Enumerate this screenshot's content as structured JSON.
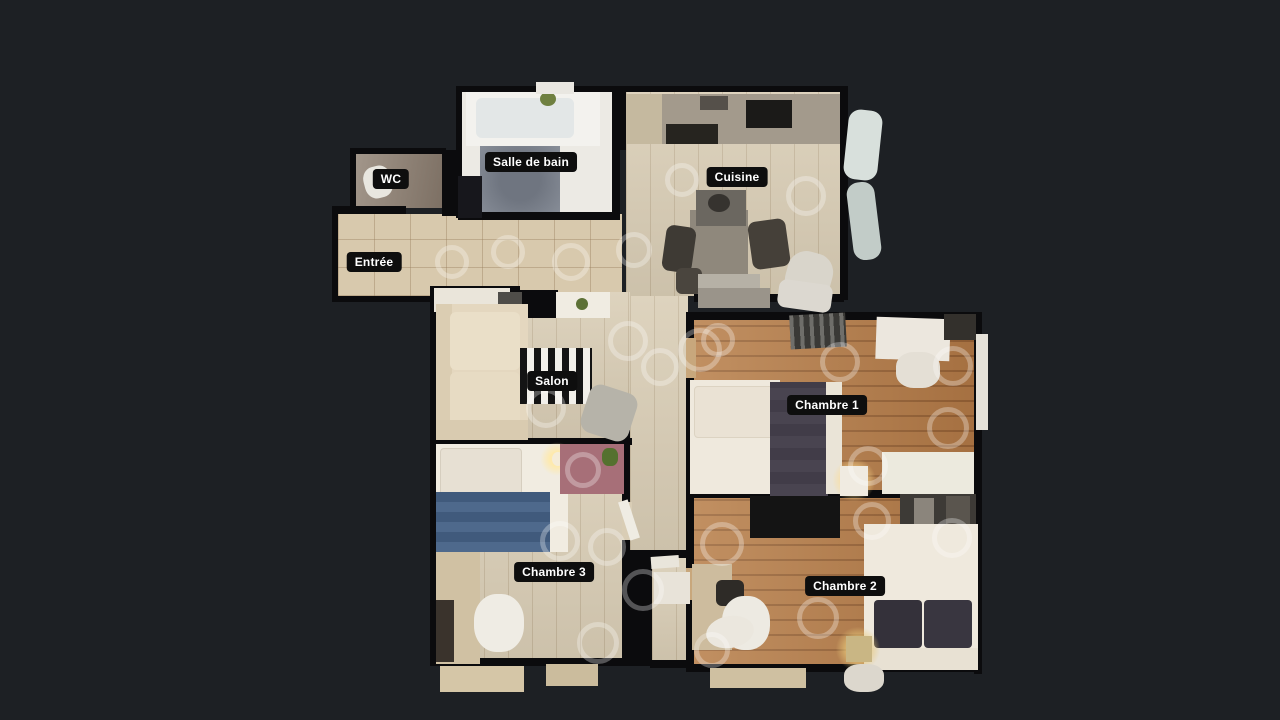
{
  "viewer": {
    "mode_label": "Floorplan view"
  },
  "rooms": [
    {
      "id": "wc",
      "label": "WC"
    },
    {
      "id": "salle-de-bain",
      "label": "Salle de bain"
    },
    {
      "id": "cuisine",
      "label": "Cuisine"
    },
    {
      "id": "entree",
      "label": "Entrée"
    },
    {
      "id": "salon",
      "label": "Salon"
    },
    {
      "id": "chambre-1",
      "label": "Chambre 1"
    },
    {
      "id": "chambre-3",
      "label": "Chambre 3"
    },
    {
      "id": "chambre-2",
      "label": "Chambre 2"
    }
  ],
  "colors": {
    "background": "#1d2024",
    "wall": "#0b0b0d",
    "label_bg": "#0e0e0e",
    "label_text": "#ffffff",
    "ring": "rgba(255,255,255,0.30)",
    "floor_light": "#d9cdb5",
    "floor_tile": "#d8c9ad",
    "floor_wood": "#b57d4a",
    "floor_bath": "#eceae4",
    "floor_wc": "#8b7f73"
  },
  "scan_points": [
    {
      "x": 452,
      "y": 262,
      "d": 34
    },
    {
      "x": 508,
      "y": 252,
      "d": 34
    },
    {
      "x": 571,
      "y": 262,
      "d": 38
    },
    {
      "x": 634,
      "y": 250,
      "d": 36
    },
    {
      "x": 682,
      "y": 180,
      "d": 34
    },
    {
      "x": 806,
      "y": 196,
      "d": 40
    },
    {
      "x": 628,
      "y": 341,
      "d": 40
    },
    {
      "x": 700,
      "y": 350,
      "d": 44
    },
    {
      "x": 660,
      "y": 367,
      "d": 38
    },
    {
      "x": 546,
      "y": 408,
      "d": 40
    },
    {
      "x": 840,
      "y": 362,
      "d": 40
    },
    {
      "x": 953,
      "y": 366,
      "d": 40
    },
    {
      "x": 948,
      "y": 428,
      "d": 42
    },
    {
      "x": 868,
      "y": 466,
      "d": 40
    },
    {
      "x": 718,
      "y": 340,
      "d": 34
    },
    {
      "x": 722,
      "y": 544,
      "d": 44
    },
    {
      "x": 872,
      "y": 521,
      "d": 38
    },
    {
      "x": 952,
      "y": 538,
      "d": 40
    },
    {
      "x": 818,
      "y": 618,
      "d": 42
    },
    {
      "x": 583,
      "y": 470,
      "d": 36
    },
    {
      "x": 560,
      "y": 541,
      "d": 40
    },
    {
      "x": 607,
      "y": 547,
      "d": 38
    },
    {
      "x": 643,
      "y": 590,
      "d": 42
    },
    {
      "x": 598,
      "y": 643,
      "d": 42
    },
    {
      "x": 712,
      "y": 650,
      "d": 36
    }
  ]
}
